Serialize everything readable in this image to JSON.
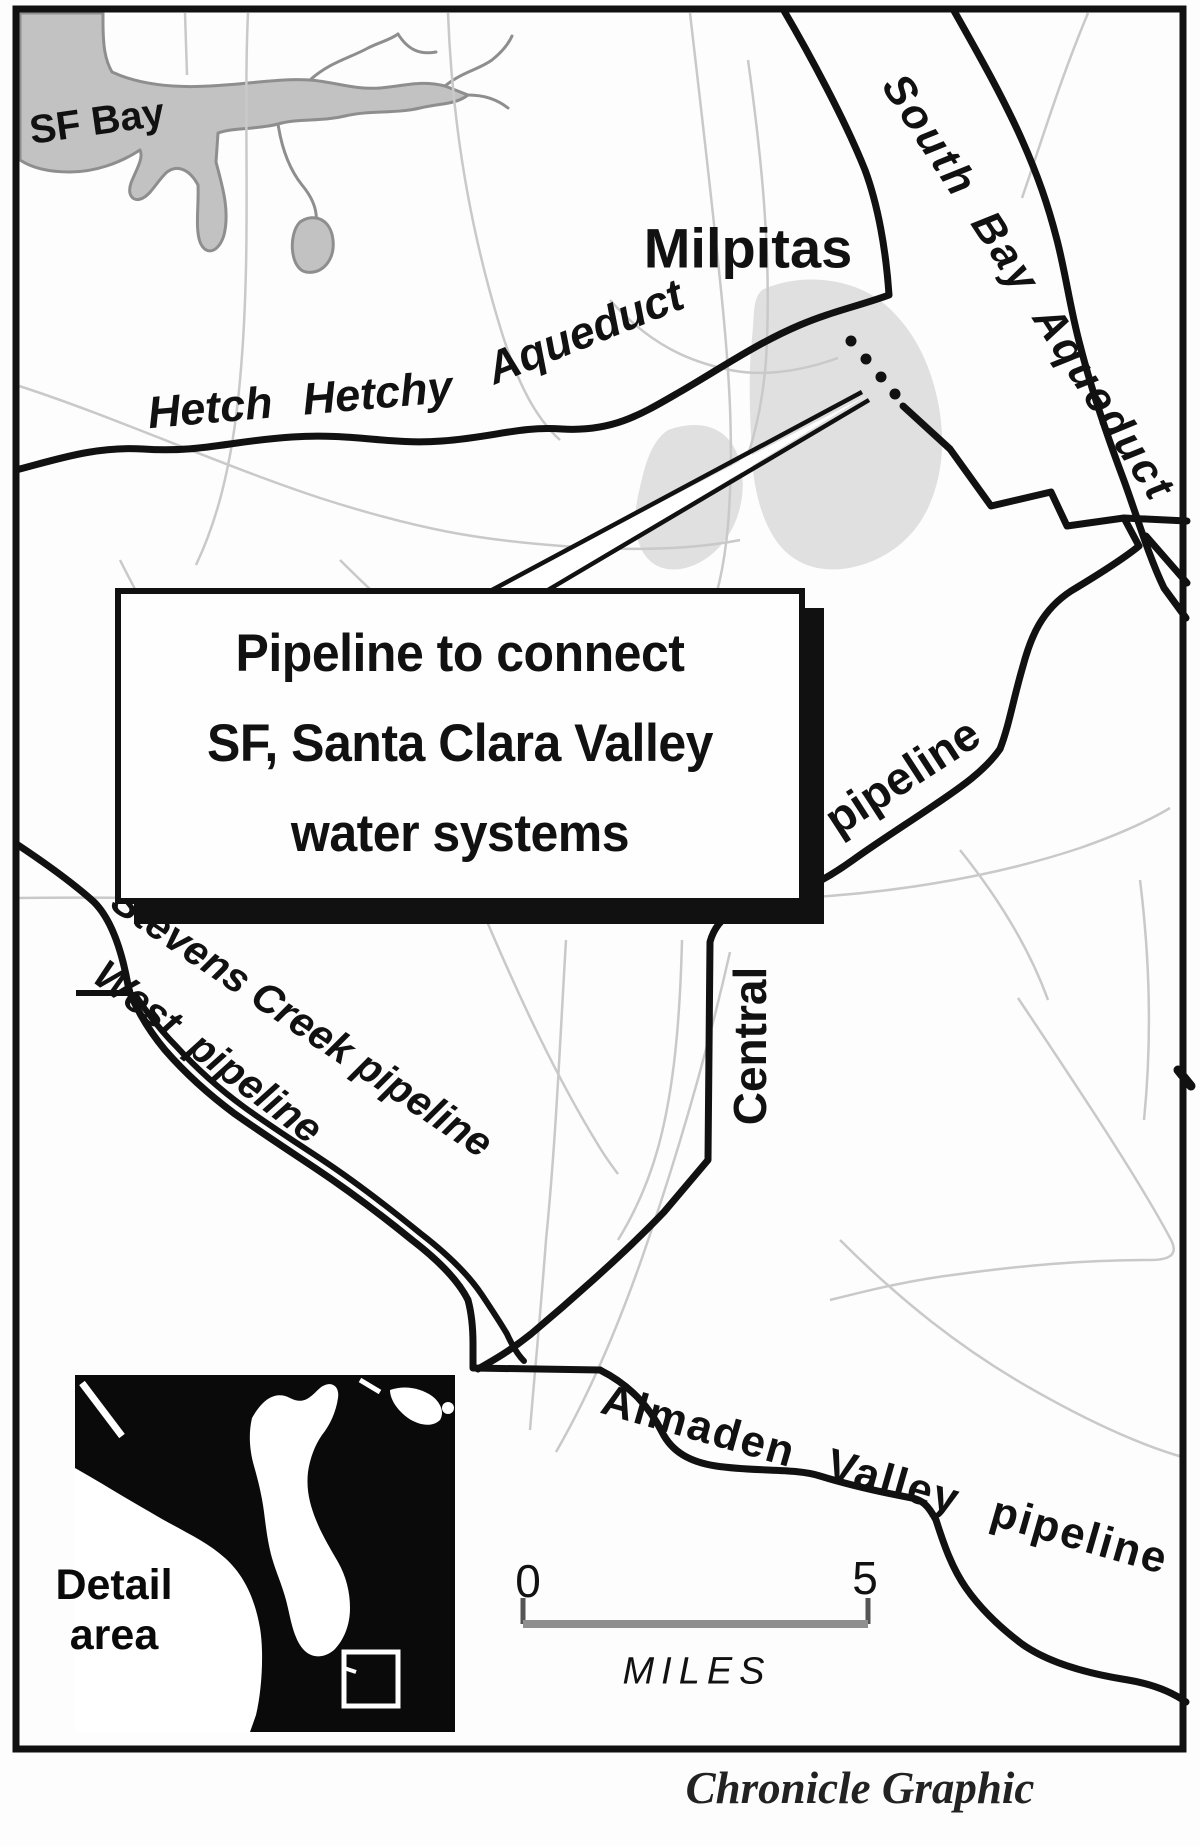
{
  "map": {
    "labels": {
      "sf_bay": "SF Bay",
      "milpitas": "Milpitas",
      "hetch_hetchy": "Hetch Hetchy",
      "hetch_hetchy_aqueduct": "Aqueduct",
      "south_bay_aqueduct": "South Bay Aqueduct",
      "central": "Central",
      "central_pipeline": "pipeline",
      "stevens_creek_pipeline": "Stevens Creek pipeline",
      "west_pipeline": "West pipeline",
      "almaden_valley_pipeline": "Almaden Valley pipeline"
    },
    "callout": {
      "line1": "Pipeline to connect",
      "line2": "SF, Santa Clara Valley",
      "line3": "water systems"
    },
    "inset": {
      "line1": "Detail",
      "line2": "area"
    },
    "scale_bar": {
      "start": "0",
      "end": "5",
      "unit": "MILES"
    },
    "credit": "Chronicle Graphic",
    "colors": {
      "line": "#111111",
      "road": "#c9c9c9",
      "bay_fill": "#c2c2c2",
      "bay_outline": "#8e8e8e",
      "city_fill": "#e0e0e0",
      "inset_bg": "#0a0a0a",
      "scale_bar": "#8f8f8f"
    }
  }
}
